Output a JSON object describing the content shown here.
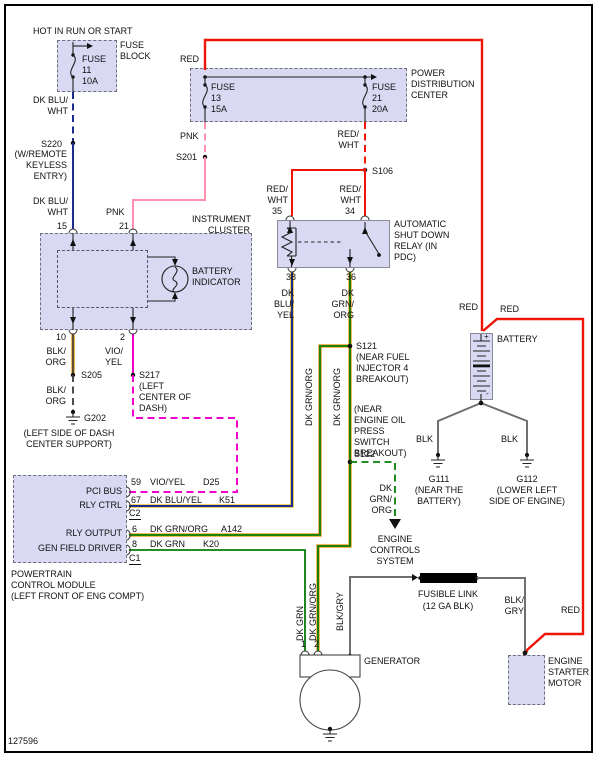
{
  "doc": {
    "number": "127596"
  },
  "colors": {
    "wire_red": "#ee1408",
    "wire_pink": "#ff8fae",
    "wire_dk_blue": "#1d2b8e",
    "wire_magenta": "#f200cc",
    "wire_green": "#067d06",
    "yellow_stripe": "#e8c235",
    "orange_stripe": "#ef9d20",
    "wire_gray": "#6f6f6f",
    "box_fill": "#d9d9f3"
  },
  "feeds": {
    "hot": "HOT IN RUN OR START"
  },
  "fuse_block": {
    "name": "FUSE BLOCK",
    "fuse": "FUSE",
    "number": "11",
    "rating": "10A"
  },
  "pdc": {
    "name": "POWER DISTRIBUTION CENTER",
    "fuse13": {
      "fuse": "FUSE",
      "number": "13",
      "rating": "15A"
    },
    "fuse21": {
      "fuse": "FUSE",
      "number": "21",
      "rating": "20A"
    }
  },
  "cluster": {
    "name": "INSTRUMENT CLUSTER",
    "indicator": "BATTERY INDICATOR",
    "pin15": "15",
    "pin21": "21",
    "pin10": "10",
    "pin2": "2"
  },
  "relay": {
    "name": "AUTOMATIC SHUT DOWN RELAY (IN PDC)",
    "pin35": "35",
    "pin34": "34",
    "pin38": "38",
    "pin36": "36"
  },
  "pcm": {
    "name": "POWERTRAIN CONTROL MODULE",
    "location": "(LEFT FRONT OF ENG COMPT)",
    "rows": {
      "pci_bus": "PCI BUS",
      "rly_ctrl": "RLY CTRL",
      "rly_output": "RLY OUTPUT",
      "gen_field": "GEN FIELD DRIVER"
    },
    "pins": {
      "p59": "59",
      "p67": "67",
      "p6": "6",
      "p8": "8"
    },
    "connectors": {
      "c2": "C2",
      "c1": "C1"
    },
    "circuits": {
      "d25": "D25",
      "k51": "K51",
      "a142": "A142",
      "k20": "K20"
    }
  },
  "battery": {
    "name": "BATTERY",
    "positive": "+",
    "negative": "-"
  },
  "generator": {
    "name": "GENERATOR",
    "pin1": "1",
    "pin2": "2"
  },
  "starter": {
    "name": "ENGINE STARTER MOTOR"
  },
  "fusible_link": {
    "name": "FUSIBLE LINK",
    "spec": "(12 GA BLK)"
  },
  "engine_controls": {
    "name": "ENGINE CONTROLS SYSTEM"
  },
  "splices": {
    "s220": "S220",
    "s220_loc": "(W/REMOTE KEYLESS ENTRY)",
    "s201": "S201",
    "s106": "S106",
    "s205": "S205",
    "s217": "S217",
    "s217_loc": "(LEFT CENTER OF DASH)",
    "s121": "S121",
    "s121_loc": "(NEAR FUEL INJECTOR 4 BREAKOUT)",
    "s122": "S122",
    "s122_loc": "(NEAR ENGINE OIL PRESS SWITCH BREAKOUT)"
  },
  "grounds": {
    "g202": "G202",
    "g202_loc": "(LEFT SIDE OF DASH CENTER SUPPORT)",
    "g111": "G111",
    "g111_loc": "(NEAR THE BATTERY)",
    "g112": "G112",
    "g112_loc": "(LOWER LEFT SIDE OF ENGINE)"
  },
  "wires": {
    "dk_blu_wht_1": "DK BLU/ WHT",
    "dk_blu_wht_2": "DK BLU/ WHT",
    "red_1": "RED",
    "pnk_1": "PNK",
    "pnk_2": "PNK",
    "red_wht_f21": "RED/ WHT",
    "red_wht_35": "RED/ WHT",
    "red_wht_34": "RED/ WHT",
    "dk_blu_yel_38": "DK BLU/ YEL",
    "dk_grn_org_36": "DK GRN/ ORG",
    "blk_org_1": "BLK/ ORG",
    "blk_org_2": "BLK/ ORG",
    "vio_yel": "VIO/ YEL",
    "vio_yel_pcm": "VIO/YEL",
    "dk_blu_yel_pcm": "DK BLU/YEL",
    "dk_grn_org_pcm": "DK GRN/ORG",
    "dk_grn_pcm": "DK GRN",
    "dk_grn_org_rot1": "DK GRN/ORG",
    "dk_grn_org_rot2": "DK GRN/ORG",
    "dk_grn_org_ec": "DK GRN/ ORG",
    "red_bat_1": "RED",
    "red_bat_2": "RED",
    "red_starter": "RED",
    "blk_left": "BLK",
    "blk_right": "BLK",
    "dk_grn_rot": "DK GRN",
    "dk_grn_org_rot3": "DK GRN/ORG",
    "blk_gry_rot": "BLK/GRY",
    "blk_gry": "BLK/ GRY"
  }
}
